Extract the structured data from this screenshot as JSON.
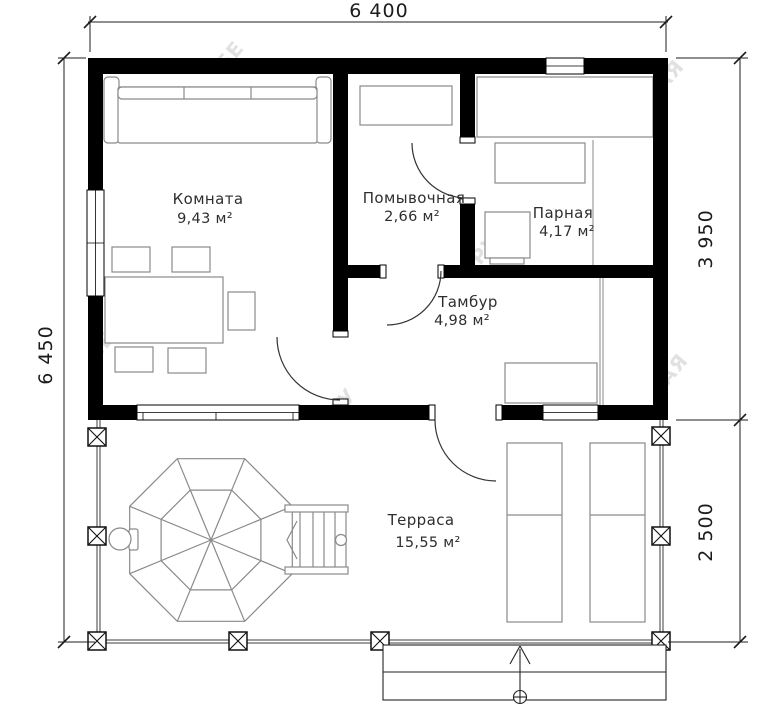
{
  "dimensions": {
    "top": "6 400",
    "left": "6 450",
    "right_upper": "3 950",
    "right_lower": "2 500"
  },
  "rooms": {
    "komnata": {
      "name": "Комната",
      "area": "9,43 м²"
    },
    "pomyvochnaya": {
      "name": "Помывочная",
      "area": "2,66 м²"
    },
    "parnaya": {
      "name": "Парная",
      "area": "4,17 м²"
    },
    "tambur": {
      "name": "Тамбур",
      "area": "4,98 м²"
    },
    "terrasa": {
      "name": "Терраса",
      "area": "15,55 м²"
    }
  },
  "watermark": {
    "fragments": [
      "БЕ",
      "АЯ",
      "СЕ",
      "РУ",
      "АЯ",
      "РУ"
    ]
  },
  "colors": {
    "wall": "#000000",
    "furniture_line": "#8a8a8a",
    "dimension_line": "#1c1c1c",
    "label_text": "#2e2e2e",
    "watermark": "#c9c9c9"
  }
}
